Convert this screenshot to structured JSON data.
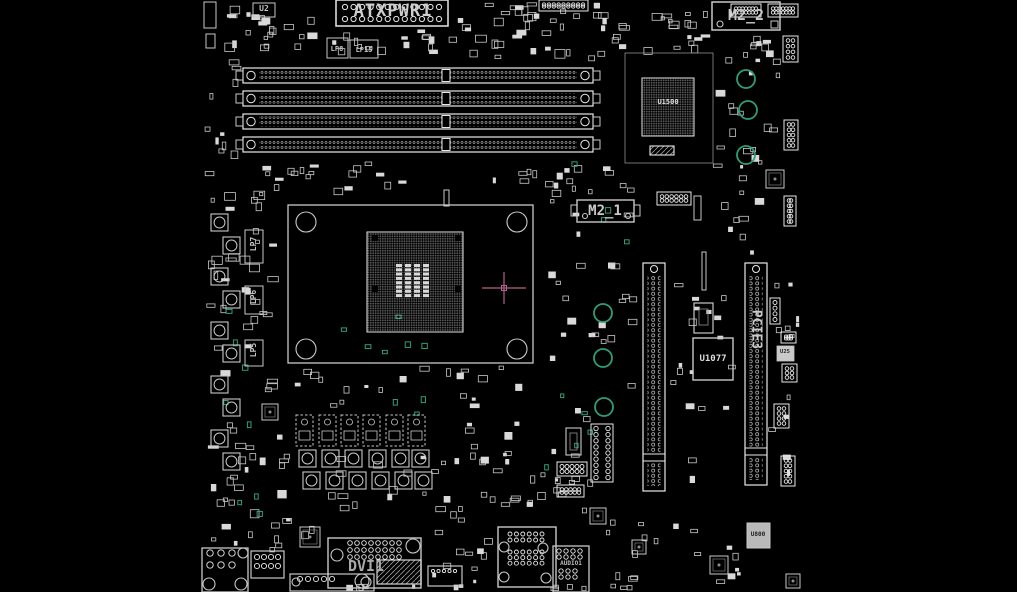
{
  "meta": {
    "type": "motherboard-boardview",
    "background": "#000000",
    "board_width": 1017,
    "board_height": 592
  },
  "colors": {
    "outline": "#c8c8c8",
    "bright": "#e8e8e8",
    "dim": "#909090",
    "fill": "#d9d9d9",
    "teal": "#2f9d77",
    "magenta": "#b3608a",
    "label": "#c4c4c4"
  },
  "labels": {
    "atxpwr1": "ATXPWR1",
    "m2_2": "M2_2",
    "m2_1": "M2_1",
    "u1500": "U1500",
    "u1077": "U1077",
    "u25": "U25",
    "u800": "U800",
    "u2": "U2",
    "pcie3": "PCIE3",
    "dvi1": "DVI1",
    "audio1": "AUDIO1",
    "lp8": "LP8",
    "lp15": "LP15",
    "lp7": "LP7",
    "lp6": "LP6",
    "lp5": "LP5"
  },
  "components": [
    {
      "t": "rect",
      "x": 204,
      "y": 2,
      "w": 12,
      "h": 26
    },
    {
      "t": "rect",
      "x": 206,
      "y": 34,
      "w": 9,
      "h": 14
    },
    {
      "t": "rect",
      "x": 253,
      "y": 3,
      "w": 22,
      "h": 14,
      "name": "chip-u2"
    },
    {
      "t": "rect",
      "x": 327,
      "y": 38,
      "w": 21,
      "h": 20,
      "name": "choke-lp8"
    },
    {
      "t": "rect",
      "x": 350,
      "y": 40,
      "w": 28,
      "h": 18,
      "name": "choke-lp15"
    },
    {
      "t": "atx",
      "x": 336,
      "y": 0,
      "w": 112,
      "h": 26,
      "name": "atx-power-connector-atxpwr1"
    },
    {
      "t": "hdr",
      "x": 539,
      "y": 0,
      "w": 49,
      "h": 11,
      "cols": 9,
      "rows": 2,
      "r": 1.7,
      "name": "pin-header"
    },
    {
      "t": "hdr",
      "x": 731,
      "y": 4,
      "w": 30,
      "h": 13,
      "cols": 7,
      "rows": 2,
      "r": 1.7,
      "name": "pin-header"
    },
    {
      "t": "hdr",
      "x": 768,
      "y": 4,
      "w": 30,
      "h": 13,
      "cols": 7,
      "rows": 2,
      "r": 1.7,
      "name": "pin-header"
    },
    {
      "t": "rect",
      "x": 712,
      "y": 2,
      "w": 68,
      "h": 28,
      "sw": 1.5,
      "name": "m2-connector-m2_2"
    },
    {
      "t": "circ",
      "x": 720,
      "y": 24,
      "r": 3
    },
    {
      "t": "rect",
      "x": 771,
      "y": 21,
      "w": 7,
      "h": 7
    },
    {
      "t": "hdr",
      "x": 783,
      "y": 36,
      "w": 15,
      "h": 26,
      "cols": 2,
      "rows": 4,
      "r": 1.8,
      "name": "pin-header"
    },
    {
      "t": "dimm",
      "x": 243,
      "y": 68,
      "w": 350,
      "h": 15,
      "name": "dimm-slot-1"
    },
    {
      "t": "dimm",
      "x": 243,
      "y": 91,
      "w": 350,
      "h": 15,
      "name": "dimm-slot-2"
    },
    {
      "t": "dimm",
      "x": 243,
      "y": 114,
      "w": 350,
      "h": 15,
      "name": "dimm-slot-3"
    },
    {
      "t": "dimm",
      "x": 243,
      "y": 137,
      "w": 350,
      "h": 15,
      "name": "dimm-slot-4"
    },
    {
      "t": "rect",
      "x": 625,
      "y": 53,
      "w": 88,
      "h": 110,
      "sw": 0.8,
      "col": "#909090",
      "name": "chipset-region"
    },
    {
      "t": "bga",
      "x": 642,
      "y": 78,
      "w": 52,
      "h": 58,
      "name": "chipset-u1500"
    },
    {
      "t": "hatch",
      "x": 650,
      "y": 146,
      "w": 24,
      "h": 9
    },
    {
      "t": "circ",
      "x": 746,
      "y": 79,
      "r": 9,
      "col": "teal",
      "sw": 1.8,
      "name": "mounting-hole"
    },
    {
      "t": "circ",
      "x": 748,
      "y": 110,
      "r": 9,
      "col": "teal",
      "sw": 1.8,
      "name": "mounting-hole"
    },
    {
      "t": "circ",
      "x": 746,
      "y": 155,
      "r": 9,
      "col": "teal",
      "sw": 1.8,
      "name": "mounting-hole"
    },
    {
      "t": "rect",
      "x": 577,
      "y": 200,
      "w": 57,
      "h": 22,
      "sw": 1.4,
      "name": "m2-connector-m2_1"
    },
    {
      "t": "rect",
      "x": 571,
      "y": 205,
      "w": 6,
      "h": 11
    },
    {
      "t": "rect",
      "x": 634,
      "y": 205,
      "w": 6,
      "h": 11
    },
    {
      "t": "circ",
      "x": 585,
      "y": 216,
      "r": 2.5
    },
    {
      "t": "circ",
      "x": 628,
      "y": 216,
      "r": 2.5
    },
    {
      "t": "hdr",
      "x": 657,
      "y": 192,
      "w": 34,
      "h": 13,
      "cols": 6,
      "rows": 2,
      "r": 1.8,
      "name": "pin-header"
    },
    {
      "t": "rect",
      "x": 694,
      "y": 196,
      "w": 7,
      "h": 24
    },
    {
      "t": "rect",
      "x": 288,
      "y": 205,
      "w": 245,
      "h": 158,
      "sw": 1.3,
      "name": "cpu-socket"
    },
    {
      "t": "circ",
      "x": 306,
      "y": 222,
      "r": 10,
      "name": "cooler-mount-hole"
    },
    {
      "t": "circ",
      "x": 517,
      "y": 222,
      "r": 10,
      "name": "cooler-mount-hole"
    },
    {
      "t": "circ",
      "x": 306,
      "y": 349,
      "r": 10,
      "name": "cooler-mount-hole"
    },
    {
      "t": "circ",
      "x": 517,
      "y": 349,
      "r": 10,
      "name": "cooler-mount-hole"
    },
    {
      "t": "bga",
      "x": 367,
      "y": 232,
      "w": 96,
      "h": 100,
      "name": "cpu-pin-grid"
    },
    {
      "t": "rect",
      "x": 372,
      "y": 235,
      "w": 6,
      "h": 6,
      "fill": "#000000",
      "sw": 0
    },
    {
      "t": "rect",
      "x": 455,
      "y": 235,
      "w": 6,
      "h": 6,
      "fill": "#000000",
      "sw": 0
    },
    {
      "t": "rect",
      "x": 372,
      "y": 286,
      "w": 6,
      "h": 6,
      "fill": "#000000",
      "sw": 0
    },
    {
      "t": "rect",
      "x": 455,
      "y": 286,
      "w": 6,
      "h": 6,
      "fill": "#000000",
      "sw": 0
    },
    {
      "t": "pads",
      "x": 396,
      "y": 264,
      "cols": 4,
      "rows": 8,
      "pw": 6,
      "ph": 3,
      "px": 9,
      "py": 4.3,
      "name": "socket-center-pads"
    },
    {
      "t": "rect",
      "x": 444,
      "y": 190,
      "w": 5,
      "h": 16,
      "sw": 1
    },
    {
      "t": "cross",
      "x": 504,
      "y": 288,
      "name": "marker-crosshair"
    },
    {
      "t": "circ",
      "x": 603,
      "y": 313,
      "r": 9,
      "col": "teal",
      "sw": 1.8,
      "name": "mounting-hole"
    },
    {
      "t": "circ",
      "x": 603,
      "y": 358,
      "r": 9,
      "col": "teal",
      "sw": 1.8,
      "name": "mounting-hole"
    },
    {
      "t": "circ",
      "x": 604,
      "y": 407,
      "r": 9,
      "col": "teal",
      "sw": 1.8,
      "name": "mounting-hole"
    },
    {
      "t": "rect",
      "x": 702,
      "y": 252,
      "w": 4,
      "h": 38,
      "sw": 1
    },
    {
      "t": "slotv",
      "x": 643,
      "y": 263,
      "w": 22,
      "h": 228,
      "name": "pcie-x16-slot"
    },
    {
      "t": "slotv",
      "x": 745,
      "y": 263,
      "w": 22,
      "h": 222,
      "name": "pcie-slot-pcie3"
    },
    {
      "t": "rect",
      "x": 693,
      "y": 338,
      "w": 40,
      "h": 42,
      "sw": 1.4,
      "name": "chip-u1077"
    },
    {
      "t": "rect",
      "x": 694,
      "y": 303,
      "w": 19,
      "h": 30,
      "sw": 1.2
    },
    {
      "t": "rect",
      "x": 699,
      "y": 309,
      "w": 9,
      "h": 16,
      "sw": 0.8,
      "col": "#909090"
    },
    {
      "t": "rect",
      "x": 777,
      "y": 346,
      "w": 17,
      "h": 15,
      "fill": "#c9c9c9",
      "sw": 0.8,
      "name": "chip-u25"
    },
    {
      "t": "hdr",
      "x": 784,
      "y": 120,
      "w": 14,
      "h": 30,
      "cols": 2,
      "rows": 5,
      "r": 1.8,
      "name": "pin-header"
    },
    {
      "t": "qfn",
      "x": 766,
      "y": 170,
      "s": 18
    },
    {
      "t": "hdr",
      "x": 784,
      "y": 196,
      "w": 12,
      "h": 30,
      "cols": 2,
      "rows": 5,
      "r": 1.8,
      "name": "pin-header"
    },
    {
      "t": "hdr",
      "x": 770,
      "y": 298,
      "w": 10,
      "h": 26,
      "cols": 1,
      "rows": 4,
      "r": 2,
      "name": "pin-header"
    },
    {
      "t": "hdr",
      "x": 781,
      "y": 332,
      "w": 15,
      "h": 11,
      "cols": 3,
      "rows": 2,
      "r": 1.6,
      "name": "pin-header"
    },
    {
      "t": "hdr",
      "x": 782,
      "y": 364,
      "w": 15,
      "h": 18,
      "cols": 2,
      "rows": 3,
      "r": 1.8,
      "name": "pin-header"
    },
    {
      "t": "hdr",
      "x": 774,
      "y": 404,
      "w": 15,
      "h": 24,
      "cols": 2,
      "rows": 4,
      "r": 1.8,
      "name": "pin-header"
    },
    {
      "t": "hdr",
      "x": 781,
      "y": 456,
      "w": 14,
      "h": 30,
      "cols": 2,
      "rows": 5,
      "r": 1.8,
      "name": "pin-header"
    },
    {
      "t": "choke",
      "x": 211,
      "y": 214,
      "s": 17,
      "name": "vrm-choke"
    },
    {
      "t": "choke",
      "x": 223,
      "y": 237,
      "s": 17,
      "name": "vrm-choke"
    },
    {
      "t": "choke",
      "x": 211,
      "y": 268,
      "s": 17,
      "name": "vrm-choke"
    },
    {
      "t": "choke",
      "x": 223,
      "y": 291,
      "s": 17,
      "name": "vrm-choke"
    },
    {
      "t": "choke",
      "x": 211,
      "y": 322,
      "s": 17,
      "name": "vrm-choke"
    },
    {
      "t": "choke",
      "x": 223,
      "y": 345,
      "s": 17,
      "name": "vrm-choke"
    },
    {
      "t": "choke",
      "x": 211,
      "y": 376,
      "s": 17,
      "name": "vrm-choke"
    },
    {
      "t": "choke",
      "x": 223,
      "y": 399,
      "s": 17,
      "name": "vrm-choke"
    },
    {
      "t": "choke",
      "x": 211,
      "y": 430,
      "s": 17,
      "name": "vrm-choke"
    },
    {
      "t": "choke",
      "x": 223,
      "y": 453,
      "s": 17,
      "name": "vrm-choke"
    },
    {
      "t": "rect",
      "x": 245,
      "y": 230,
      "w": 18,
      "h": 33,
      "sw": 1,
      "name": "choke-lp7"
    },
    {
      "t": "rect",
      "x": 245,
      "y": 286,
      "w": 18,
      "h": 28,
      "sw": 1,
      "name": "choke-lp6"
    },
    {
      "t": "rect",
      "x": 245,
      "y": 340,
      "w": 18,
      "h": 26,
      "sw": 1,
      "name": "choke-lp5"
    },
    {
      "t": "drv",
      "x": 296,
      "y": 415,
      "w": 17,
      "h": 31,
      "name": "vrm-driver"
    },
    {
      "t": "drv",
      "x": 319,
      "y": 415,
      "w": 17,
      "h": 31,
      "name": "vrm-driver"
    },
    {
      "t": "drv",
      "x": 341,
      "y": 415,
      "w": 17,
      "h": 31,
      "name": "vrm-driver"
    },
    {
      "t": "drv",
      "x": 363,
      "y": 415,
      "w": 17,
      "h": 31,
      "name": "vrm-driver"
    },
    {
      "t": "drv",
      "x": 386,
      "y": 415,
      "w": 17,
      "h": 31,
      "name": "vrm-driver"
    },
    {
      "t": "drv",
      "x": 408,
      "y": 415,
      "w": 17,
      "h": 31,
      "name": "vrm-driver"
    },
    {
      "t": "choke",
      "x": 299,
      "y": 450,
      "s": 17,
      "name": "vrm-choke"
    },
    {
      "t": "choke",
      "x": 322,
      "y": 450,
      "s": 17,
      "name": "vrm-choke"
    },
    {
      "t": "choke",
      "x": 345,
      "y": 450,
      "s": 17,
      "name": "vrm-choke"
    },
    {
      "t": "choke",
      "x": 369,
      "y": 450,
      "s": 17,
      "name": "vrm-choke"
    },
    {
      "t": "choke",
      "x": 392,
      "y": 450,
      "s": 17,
      "name": "vrm-choke"
    },
    {
      "t": "choke",
      "x": 412,
      "y": 450,
      "s": 17,
      "name": "vrm-choke"
    },
    {
      "t": "choke",
      "x": 303,
      "y": 472,
      "s": 17,
      "name": "vrm-choke"
    },
    {
      "t": "choke",
      "x": 326,
      "y": 472,
      "s": 17,
      "name": "vrm-choke"
    },
    {
      "t": "choke",
      "x": 349,
      "y": 472,
      "s": 17,
      "name": "vrm-choke"
    },
    {
      "t": "choke",
      "x": 372,
      "y": 472,
      "s": 17,
      "name": "vrm-choke"
    },
    {
      "t": "choke",
      "x": 395,
      "y": 472,
      "s": 17,
      "name": "vrm-choke"
    },
    {
      "t": "choke",
      "x": 415,
      "y": 472,
      "s": 17,
      "name": "vrm-choke"
    },
    {
      "t": "rect",
      "x": 566,
      "y": 428,
      "w": 15,
      "h": 27,
      "sw": 1.1
    },
    {
      "t": "rect",
      "x": 570,
      "y": 433,
      "w": 7,
      "h": 17,
      "sw": 0.8,
      "col": "#909090"
    },
    {
      "t": "hdr",
      "x": 591,
      "y": 424,
      "w": 22,
      "h": 58,
      "cols": 2,
      "rows": 9,
      "r": 2.2,
      "name": "front-panel-header"
    },
    {
      "t": "hdr",
      "x": 557,
      "y": 462,
      "w": 30,
      "h": 14,
      "cols": 5,
      "rows": 2,
      "r": 2,
      "name": "pin-header"
    },
    {
      "t": "hdr",
      "x": 557,
      "y": 485,
      "w": 27,
      "h": 12,
      "cols": 5,
      "rows": 2,
      "r": 1.8,
      "name": "pin-header"
    },
    {
      "t": "qfn",
      "x": 590,
      "y": 508,
      "s": 16
    },
    {
      "t": "qfn",
      "x": 262,
      "y": 404,
      "s": 16
    },
    {
      "t": "qfn",
      "x": 300,
      "y": 527,
      "s": 20,
      "name": "audio-codec"
    },
    {
      "t": "rect",
      "x": 290,
      "y": 574,
      "w": 84,
      "h": 17,
      "sw": 1.2,
      "name": "edge-connector"
    },
    {
      "t": "holes",
      "x": 300,
      "y": 579,
      "cols": 5,
      "rows": 1,
      "px": 8,
      "py": 6,
      "r": 2.6
    },
    {
      "t": "circ",
      "x": 296,
      "y": 582,
      "r": 4
    },
    {
      "t": "circ",
      "x": 366,
      "y": 582,
      "r": 5
    },
    {
      "t": "rect",
      "x": 202,
      "y": 548,
      "w": 46,
      "h": 44,
      "sw": 1.3,
      "name": "audio-jack-stack"
    },
    {
      "t": "holes",
      "x": 210,
      "y": 553,
      "cols": 3,
      "rows": 2,
      "px": 11,
      "py": 12,
      "r": 3.2
    },
    {
      "t": "circ",
      "x": 209,
      "y": 584,
      "r": 6
    },
    {
      "t": "circ",
      "x": 241,
      "y": 584,
      "r": 6
    },
    {
      "t": "circ",
      "x": 243,
      "y": 553,
      "r": 5
    },
    {
      "t": "rect",
      "x": 251,
      "y": 551,
      "w": 33,
      "h": 27,
      "sw": 1.2,
      "name": "connector"
    },
    {
      "t": "holes",
      "x": 257,
      "y": 557,
      "cols": 4,
      "rows": 2,
      "px": 7,
      "py": 9,
      "r": 2.6
    },
    {
      "t": "rect",
      "x": 328,
      "y": 538,
      "w": 93,
      "h": 50,
      "sw": 1.4,
      "name": "dvi-connector-dvi1"
    },
    {
      "t": "holes",
      "x": 350,
      "y": 543,
      "cols": 8,
      "rows": 3,
      "px": 7,
      "py": 7,
      "r": 2.3
    },
    {
      "t": "circ",
      "x": 337,
      "y": 555,
      "r": 6
    },
    {
      "t": "circ",
      "x": 362,
      "y": 581,
      "r": 7
    },
    {
      "t": "circ",
      "x": 413,
      "y": 546,
      "r": 7
    },
    {
      "t": "hatch",
      "x": 377,
      "y": 560,
      "w": 44,
      "h": 24,
      "name": "hdmi-connector"
    },
    {
      "t": "rect",
      "x": 428,
      "y": 566,
      "w": 34,
      "h": 20,
      "sw": 1.2,
      "name": "video-connector"
    },
    {
      "t": "holes",
      "x": 433,
      "y": 571,
      "cols": 5,
      "rows": 1,
      "px": 5.5,
      "py": 6,
      "r": 1.6
    },
    {
      "t": "rect",
      "x": 498,
      "y": 527,
      "w": 58,
      "h": 60,
      "sw": 1.4,
      "name": "usb-lan-stack"
    },
    {
      "t": "holes",
      "x": 510,
      "y": 534,
      "cols": 6,
      "rows": 2,
      "px": 6.4,
      "py": 6,
      "r": 2
    },
    {
      "t": "holes",
      "x": 510,
      "y": 552,
      "cols": 6,
      "rows": 3,
      "px": 6.4,
      "py": 5.6,
      "r": 2
    },
    {
      "t": "circ",
      "x": 504,
      "y": 547,
      "r": 5
    },
    {
      "t": "circ",
      "x": 504,
      "y": 577,
      "r": 5
    },
    {
      "t": "circ",
      "x": 543,
      "y": 548,
      "r": 5
    },
    {
      "t": "circ",
      "x": 546,
      "y": 578,
      "r": 5
    },
    {
      "t": "rect",
      "x": 553,
      "y": 546,
      "w": 36,
      "h": 46,
      "sw": 1.3,
      "name": "audio-header-audio1"
    },
    {
      "t": "holes",
      "x": 559,
      "y": 551,
      "cols": 4,
      "rows": 2,
      "px": 7,
      "py": 6,
      "r": 2.2
    },
    {
      "t": "holes",
      "x": 561,
      "y": 571,
      "cols": 3,
      "rows": 2,
      "px": 7,
      "py": 6,
      "r": 2.2
    },
    {
      "t": "qfn",
      "x": 632,
      "y": 540,
      "s": 14
    },
    {
      "t": "qfn",
      "x": 710,
      "y": 556,
      "s": 18
    },
    {
      "t": "qfn",
      "x": 786,
      "y": 574,
      "s": 14
    },
    {
      "t": "rect",
      "x": 747,
      "y": 523,
      "w": 23,
      "h": 25,
      "sw": 1,
      "fill": "#b9b9b9",
      "name": "chip-u800"
    }
  ],
  "decor": {
    "seed": 1337,
    "clusters": [
      [
        210,
        0,
        115,
        58,
        22,
        3,
        12
      ],
      [
        330,
        28,
        128,
        30,
        16,
        3,
        10
      ],
      [
        455,
        0,
        175,
        62,
        40,
        3,
        11
      ],
      [
        600,
        8,
        112,
        48,
        20,
        3,
        10
      ],
      [
        716,
        34,
        62,
        30,
        10,
        3,
        9
      ],
      [
        205,
        58,
        38,
        108,
        10,
        3,
        10
      ],
      [
        205,
        160,
        82,
        198,
        30,
        3,
        11
      ],
      [
        205,
        360,
        82,
        158,
        24,
        3,
        11
      ],
      [
        255,
        160,
        330,
        36,
        26,
        3,
        9
      ],
      [
        540,
        165,
        95,
        58,
        14,
        3,
        9
      ],
      [
        545,
        228,
        92,
        172,
        20,
        3,
        9
      ],
      [
        545,
        405,
        48,
        112,
        12,
        3,
        8
      ],
      [
        712,
        58,
        70,
        200,
        26,
        3,
        10
      ],
      [
        668,
        282,
        72,
        205,
        18,
        3,
        9
      ],
      [
        768,
        282,
        34,
        232,
        12,
        3,
        8
      ],
      [
        290,
        366,
        245,
        44,
        20,
        3,
        10
      ],
      [
        250,
        452,
        300,
        72,
        24,
        3,
        10
      ],
      [
        420,
        420,
        135,
        102,
        20,
        3,
        10
      ],
      [
        205,
        518,
        115,
        34,
        12,
        3,
        10
      ],
      [
        425,
        528,
        70,
        56,
        10,
        3,
        9
      ],
      [
        598,
        518,
        168,
        68,
        18,
        3,
        9
      ],
      [
        295,
        584,
        340,
        7,
        14,
        3,
        8
      ]
    ],
    "teal_clusters": [
      [
        332,
        286,
        108,
        72,
        6
      ],
      [
        540,
        358,
        58,
        128,
        5
      ],
      [
        205,
        288,
        66,
        168,
        5
      ],
      [
        565,
        152,
        88,
        108,
        4
      ],
      [
        352,
        378,
        76,
        40,
        3
      ],
      [
        208,
        462,
        76,
        56,
        3
      ]
    ]
  }
}
